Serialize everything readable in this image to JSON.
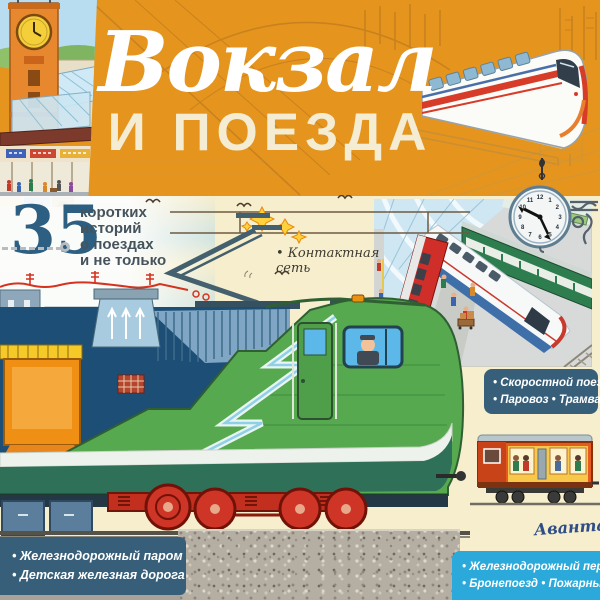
{
  "title": {
    "script": "Вокзал",
    "caps": "И ПОЕЗДА"
  },
  "badge": {
    "number": "35",
    "line1": "коротких",
    "line2": "историй",
    "line3": "о поездах",
    "line4": "и не только"
  },
  "labels": {
    "contact": "• Контактная сеть",
    "speed_panel": {
      "line1": "• Скоростной поезд",
      "line2": "• Паровоз • Трамвай"
    },
    "ferry_panel": {
      "line1": "• Железнодорожный паром",
      "line2": "• Детская железная дорога"
    },
    "crossing_panel": {
      "line1": "• Железнодорожный переезд",
      "line2": "• Бронепоезд • Пожарный поезд"
    }
  },
  "publisher": {
    "name": "Аванта"
  },
  "clock": {
    "numerals": [
      "12",
      "1",
      "2",
      "3",
      "4",
      "5",
      "6",
      "7",
      "8",
      "9",
      "10",
      "11"
    ]
  },
  "colors": {
    "orange": "#e5951e",
    "cream": "#f6eecd",
    "slate_panel": "#385f7a",
    "cyan_panel": "#2aa9da",
    "loco_green": "#56a94f",
    "badge_blue": "#2d5f82"
  }
}
